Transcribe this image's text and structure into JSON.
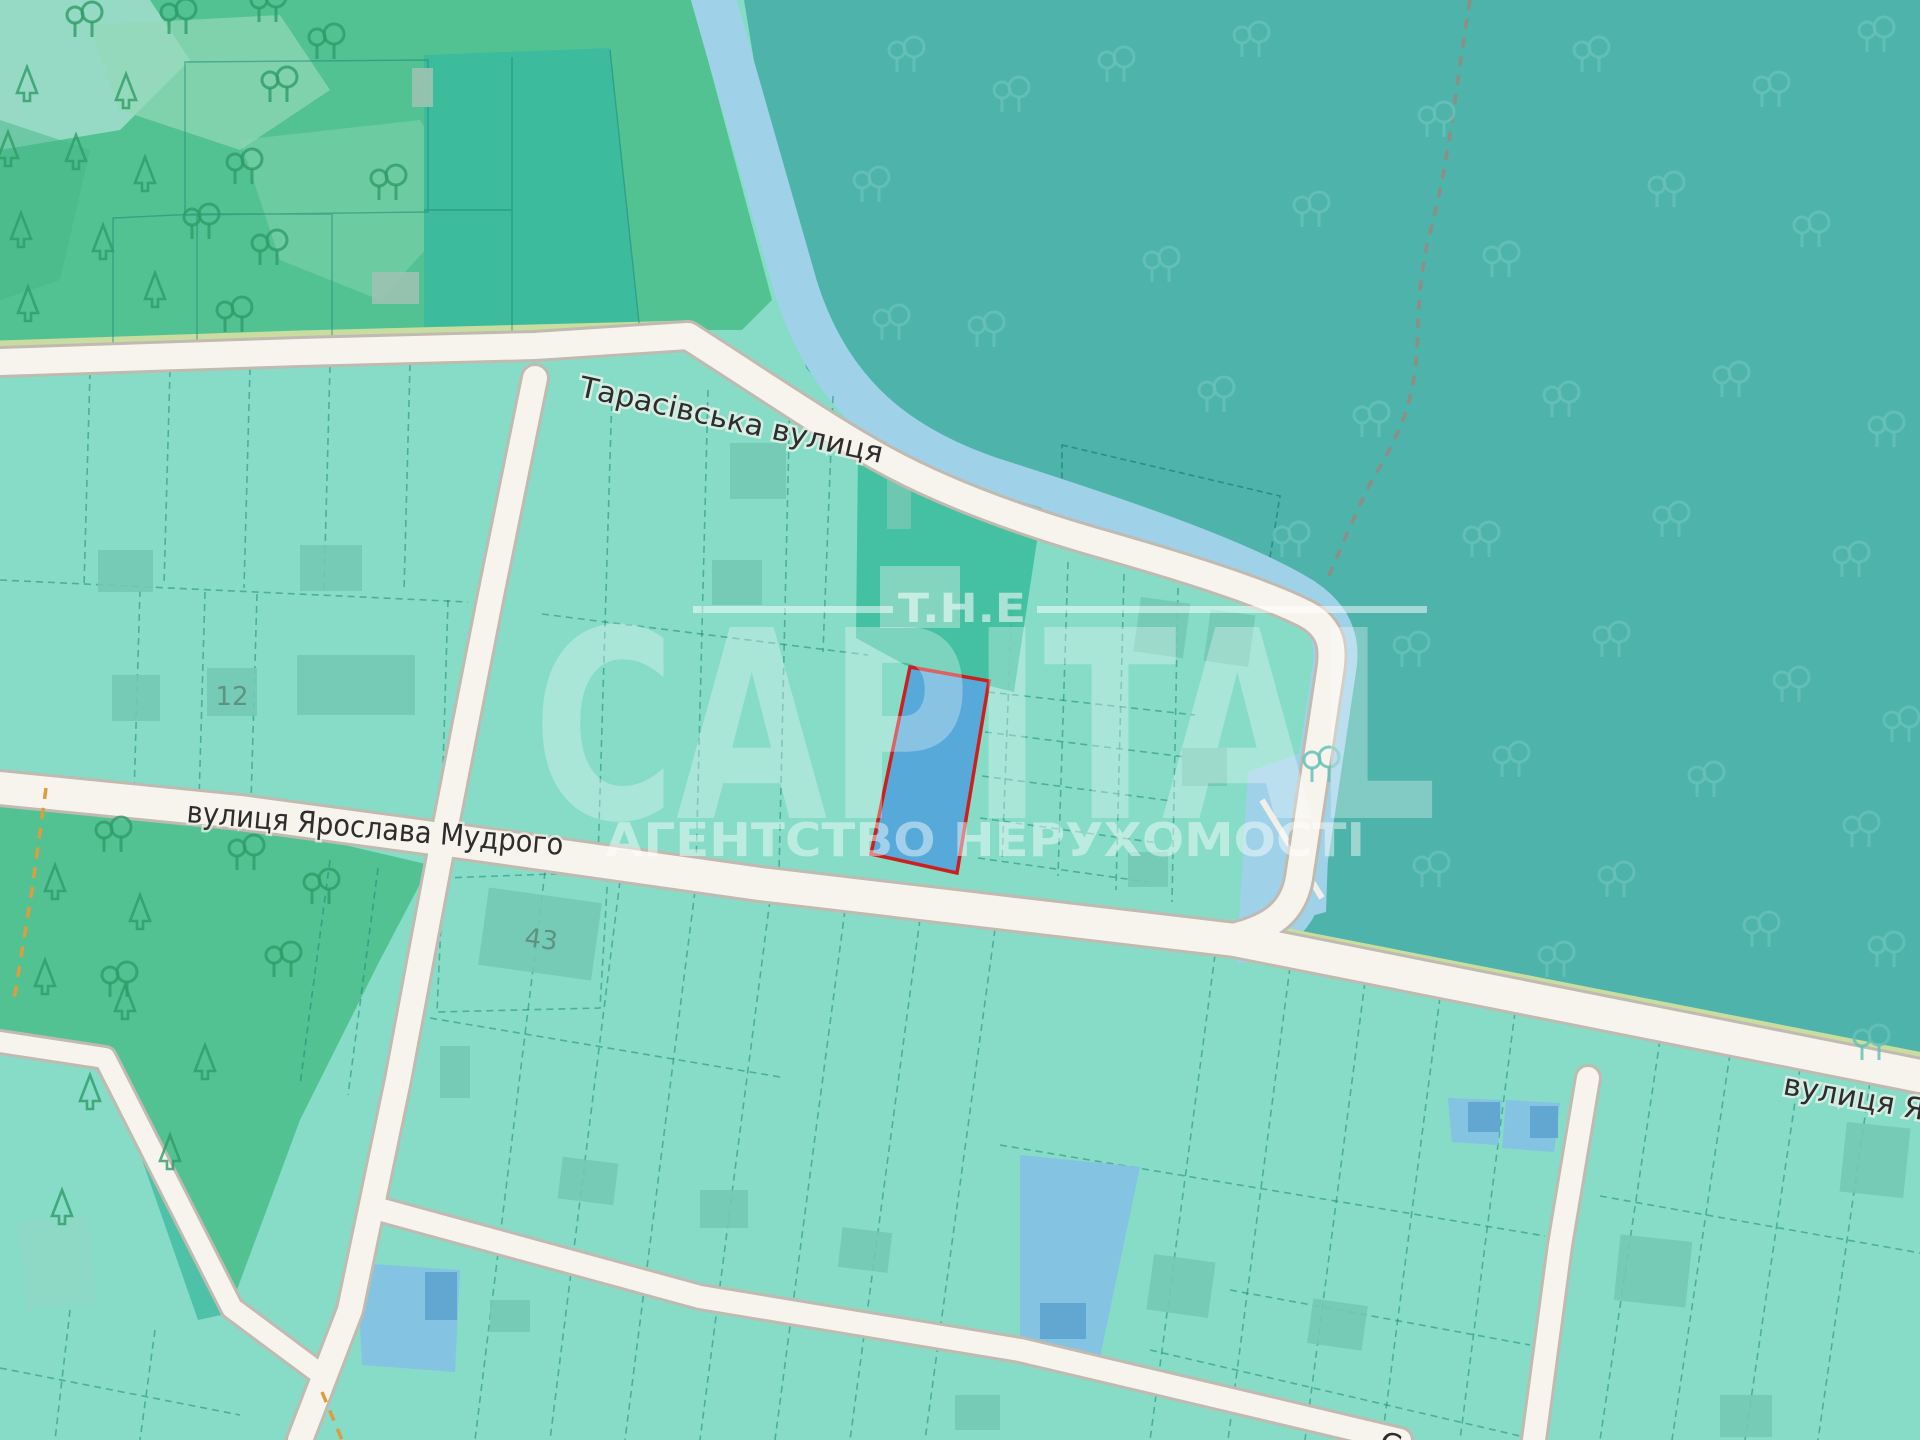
{
  "map": {
    "streets": {
      "tarasivska": "Тарасівська вулиця",
      "mudroho": "вулиця Ярослава Мудрого",
      "right_partial": "вулиця Яро",
      "bottom_partial": "Ст"
    },
    "labels": {
      "parcel_12": "12",
      "parcel_43": "43"
    },
    "watermark": {
      "top": "T.H.E",
      "brand": "CAPITAL",
      "subtitle": "АГЕНТСТВО НЕРУХОМОСТІ"
    },
    "colors": {
      "parcel_base": "#86dcc7",
      "forest_dark_teal": "#4db3ab",
      "forest_green": "#53c293",
      "teal_parcel": "#3dbc9d",
      "road_fill": "#f7f4ee",
      "road_casing": "#c0bab0",
      "road_edge_green": "#c9dda0",
      "water_strip": "#9fd2e9",
      "highlight_parcel_fill": "#57a9d9",
      "highlight_parcel_stroke": "#ce1f1f",
      "blue_parcel": "#84c1e4",
      "building": "#73c9b3",
      "street_label": "#2d2d2d",
      "watermark": "#ffffff",
      "path_dashed_orange": "#dd9c3f",
      "path_dashed_grey": "#8e8e85"
    }
  }
}
